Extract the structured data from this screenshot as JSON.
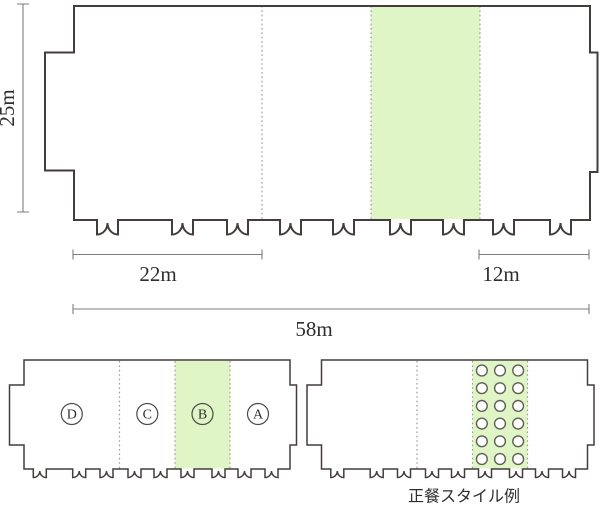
{
  "colors": {
    "wall": "#453c3c",
    "highlight": "#dff5c6",
    "dotted": "#9c9c94",
    "dim": "#7d7d7d",
    "text": "#2e2e2e",
    "table": "#5f5f55"
  },
  "main_plan": {
    "dimensions": {
      "height": "25m",
      "left_section": "22m",
      "right_section": "12m",
      "total": "58m"
    }
  },
  "section_plan": {
    "sections": [
      {
        "label": "D"
      },
      {
        "label": "C"
      },
      {
        "label": "B",
        "highlighted": true
      },
      {
        "label": "A"
      }
    ],
    "highlighted_section": "B"
  },
  "dinner_plan": {
    "caption": "正餐スタイル例",
    "tables": {
      "rows": 6,
      "cols": 3
    }
  }
}
